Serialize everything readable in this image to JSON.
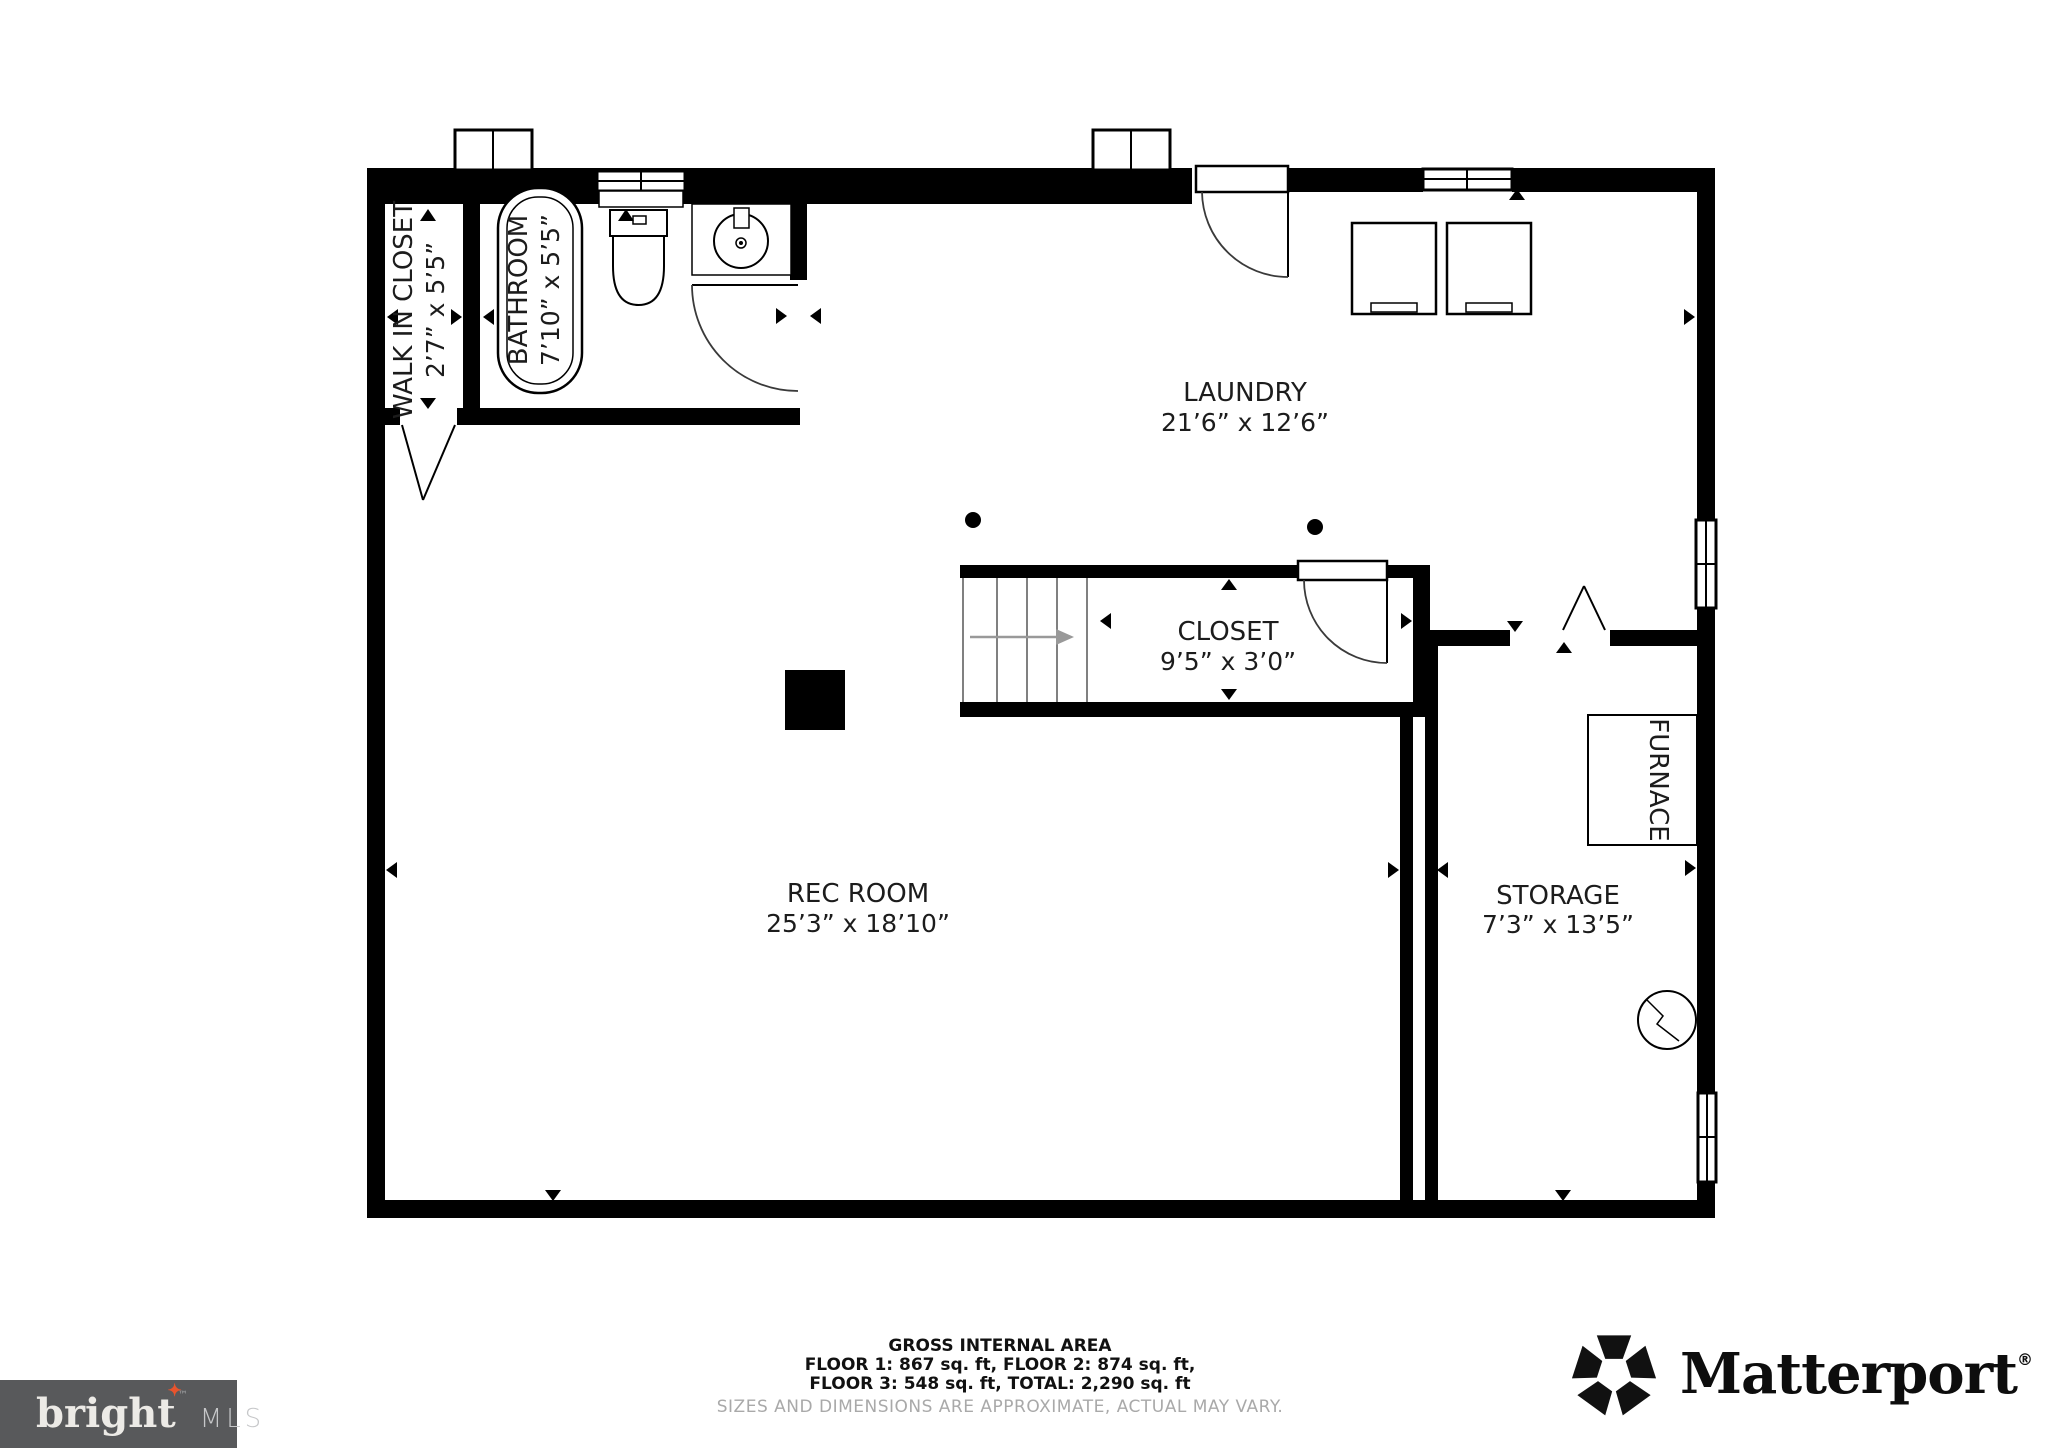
{
  "plan": {
    "rooms": {
      "walk_in_closet": {
        "name": "WALK IN CLOSET",
        "dims": "2’7” x 5’5”"
      },
      "bathroom": {
        "name": "BATHROOM",
        "dims": "7’10” x 5’5”"
      },
      "laundry": {
        "name": "LAUNDRY",
        "dims": "21’6” x 12’6”"
      },
      "closet": {
        "name": "CLOSET",
        "dims": "9’5” x 3’0”"
      },
      "rec_room": {
        "name": "REC ROOM",
        "dims": "25’3” x 18’10”"
      },
      "storage": {
        "name": "STORAGE",
        "dims": "7’3” x 13’5”"
      },
      "furnace": {
        "name": "FURNACE"
      }
    }
  },
  "footer": {
    "title": "GROSS INTERNAL AREA",
    "line1": "FLOOR 1: 867 sq. ft, FLOOR 2: 874 sq. ft,",
    "line2": "FLOOR 3: 548 sq. ft, TOTAL: 2,290 sq. ft",
    "disclaimer": "SIZES AND DIMENSIONS ARE APPROXIMATE, ACTUAL MAY VARY."
  },
  "logos": {
    "bright_mls": {
      "brand": "bright",
      "tm": "™",
      "suffix": "MLS"
    },
    "matterport": {
      "brand": "Matterport",
      "registered": "®"
    }
  }
}
